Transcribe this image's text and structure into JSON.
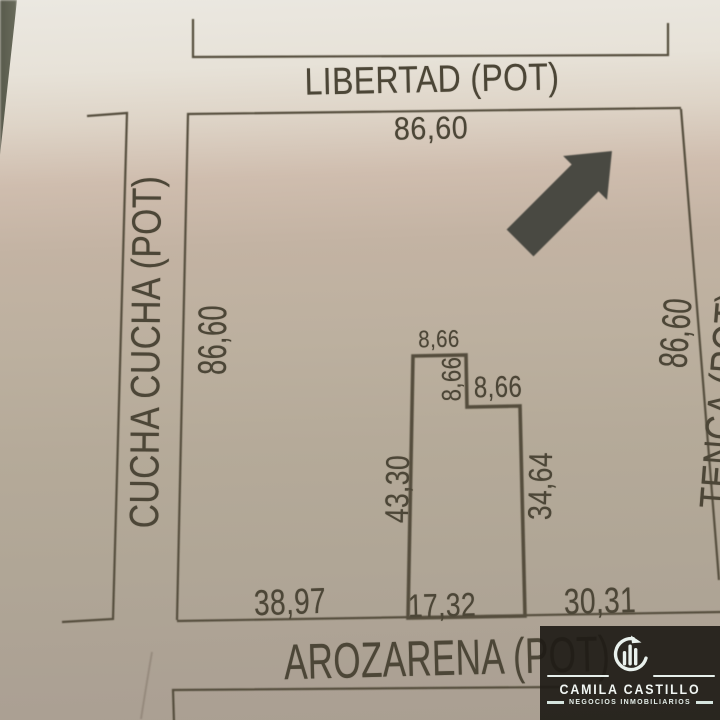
{
  "plan": {
    "streets": {
      "top": "LIBERTAD (POT)",
      "left": "CUCHA CUCHA (POT)",
      "bottom": "AROZARENA (POT)",
      "right_partial": "TENCA (POT)"
    },
    "block": {
      "top": "86,60",
      "left": "86,60",
      "right": "86,60",
      "bottom_left": "38,97",
      "bottom_right": "30,31"
    },
    "parcel": {
      "top": "8,66",
      "notch_side": "8,66",
      "notch_top": "8,66",
      "left": "43,30",
      "right": "34,64",
      "bottom": "17,32"
    }
  },
  "compass": {
    "icon": "northeast-arrow"
  },
  "watermark": {
    "brand": "CAMILA CASTILLO",
    "tagline": "NEGOCIOS INMOBILIARIOS",
    "colors": {
      "background": "#211e19",
      "text": "#eef4f1",
      "accent": "#d9e7e1"
    }
  },
  "photo": {
    "ink_color": "#4c4637",
    "paper_top": "#ebe8e1",
    "paper_bottom": "#aa9f92"
  }
}
